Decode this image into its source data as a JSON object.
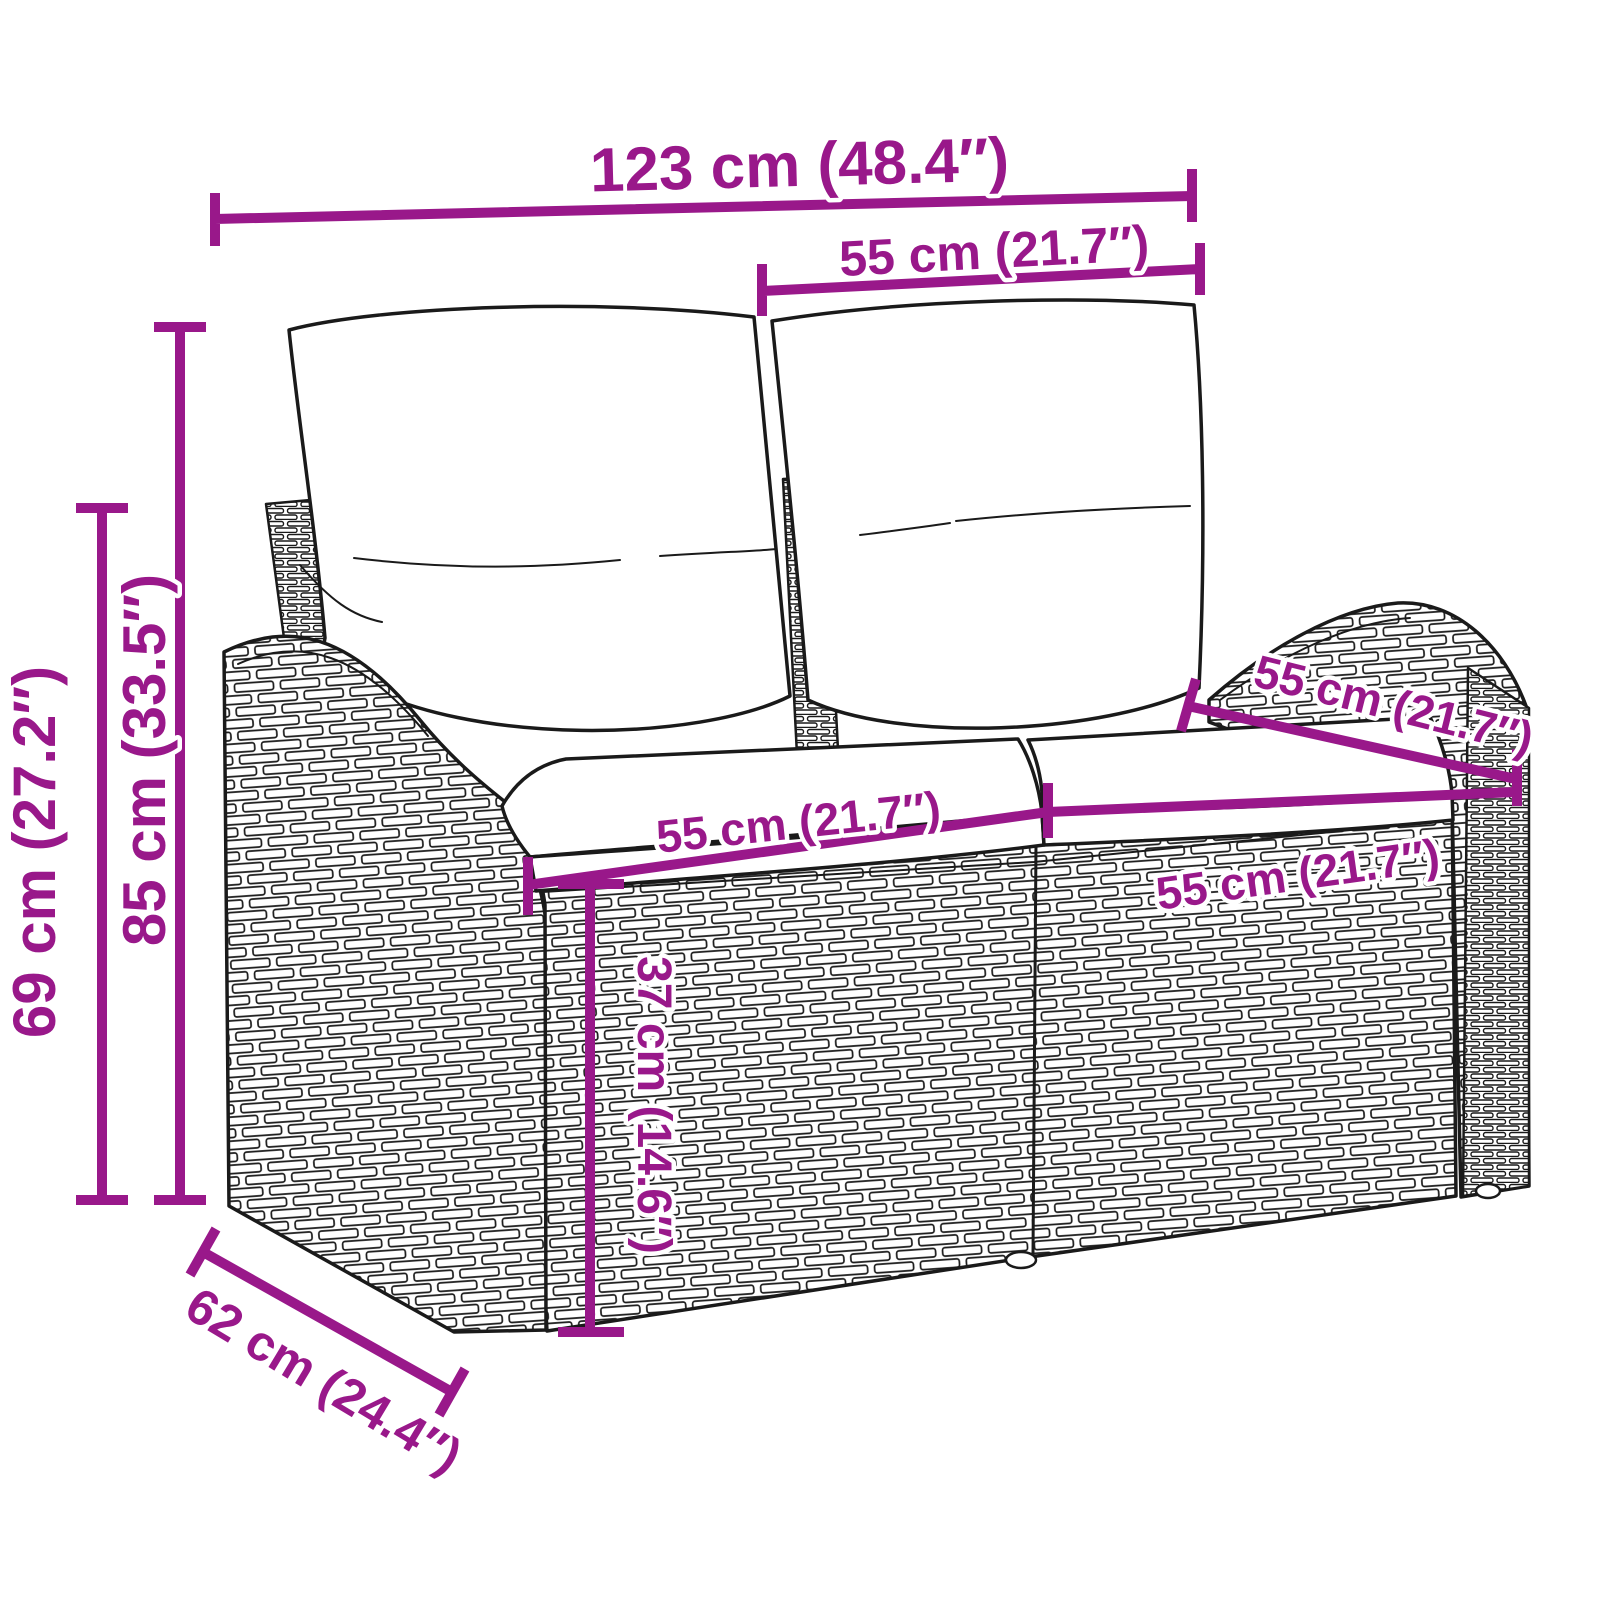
{
  "colors": {
    "accent": "#99188A",
    "line": "#1A1A1A",
    "background": "#FFFFFF"
  },
  "dim": {
    "total_width": "123 cm (48.4″)",
    "back_section_width": "55 cm (21.7″)",
    "total_height": "85 cm (33.5″)",
    "arm_height": "69 cm (27.2″)",
    "seat_depth": "55 cm (21.7″)",
    "left_seat_width": "55 cm (21.7″)",
    "right_seat_width": "55 cm (21.7″)",
    "seat_height": "37 cm (14.6″)",
    "total_depth": "62 cm (24.4″)"
  }
}
